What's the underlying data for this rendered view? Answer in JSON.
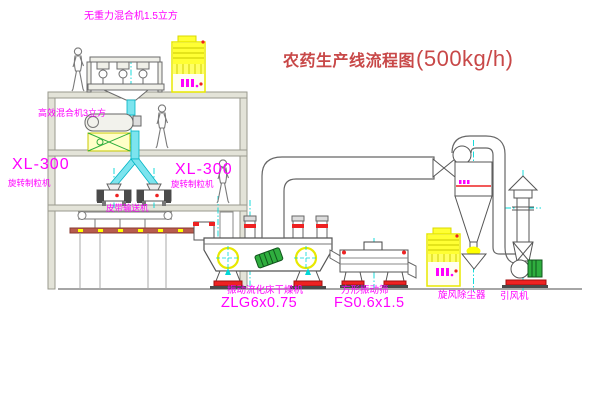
{
  "title": {
    "zh": "农药生产线流程图",
    "spec": "(500kg/h)"
  },
  "equipment": {
    "top_mixer": {
      "label": "无重力混合机1.5立方"
    },
    "high_eff_mixer": {
      "label": "高效混合机3立方"
    },
    "granulator_left": {
      "model": "XL-300",
      "name": "旋转制粒机"
    },
    "granulator_right": {
      "model": "XL-300",
      "name": "旋转制粒机"
    },
    "belt_conveyor": {
      "name": "皮带输送机"
    },
    "fluid_bed_dryer": {
      "name": "振动流化床干燥机",
      "model": "ZLG6x0.75"
    },
    "vibrating_sieve": {
      "name": "方形振动筛",
      "model": "FS0.6x1.5"
    },
    "cyclone": {
      "name": "旋风除尘器"
    },
    "induced_draft_fan": {
      "name": "引风机"
    }
  },
  "colors": {
    "label_magenta": "#ff00ff",
    "title_red": "#c84848",
    "equipment_yellow": "#ffff00",
    "centerline_cyan": "#00d8d8",
    "accent_red": "#ee2222",
    "accent_green": "#2fae3e",
    "structure_gray": "#9a9a8e"
  }
}
